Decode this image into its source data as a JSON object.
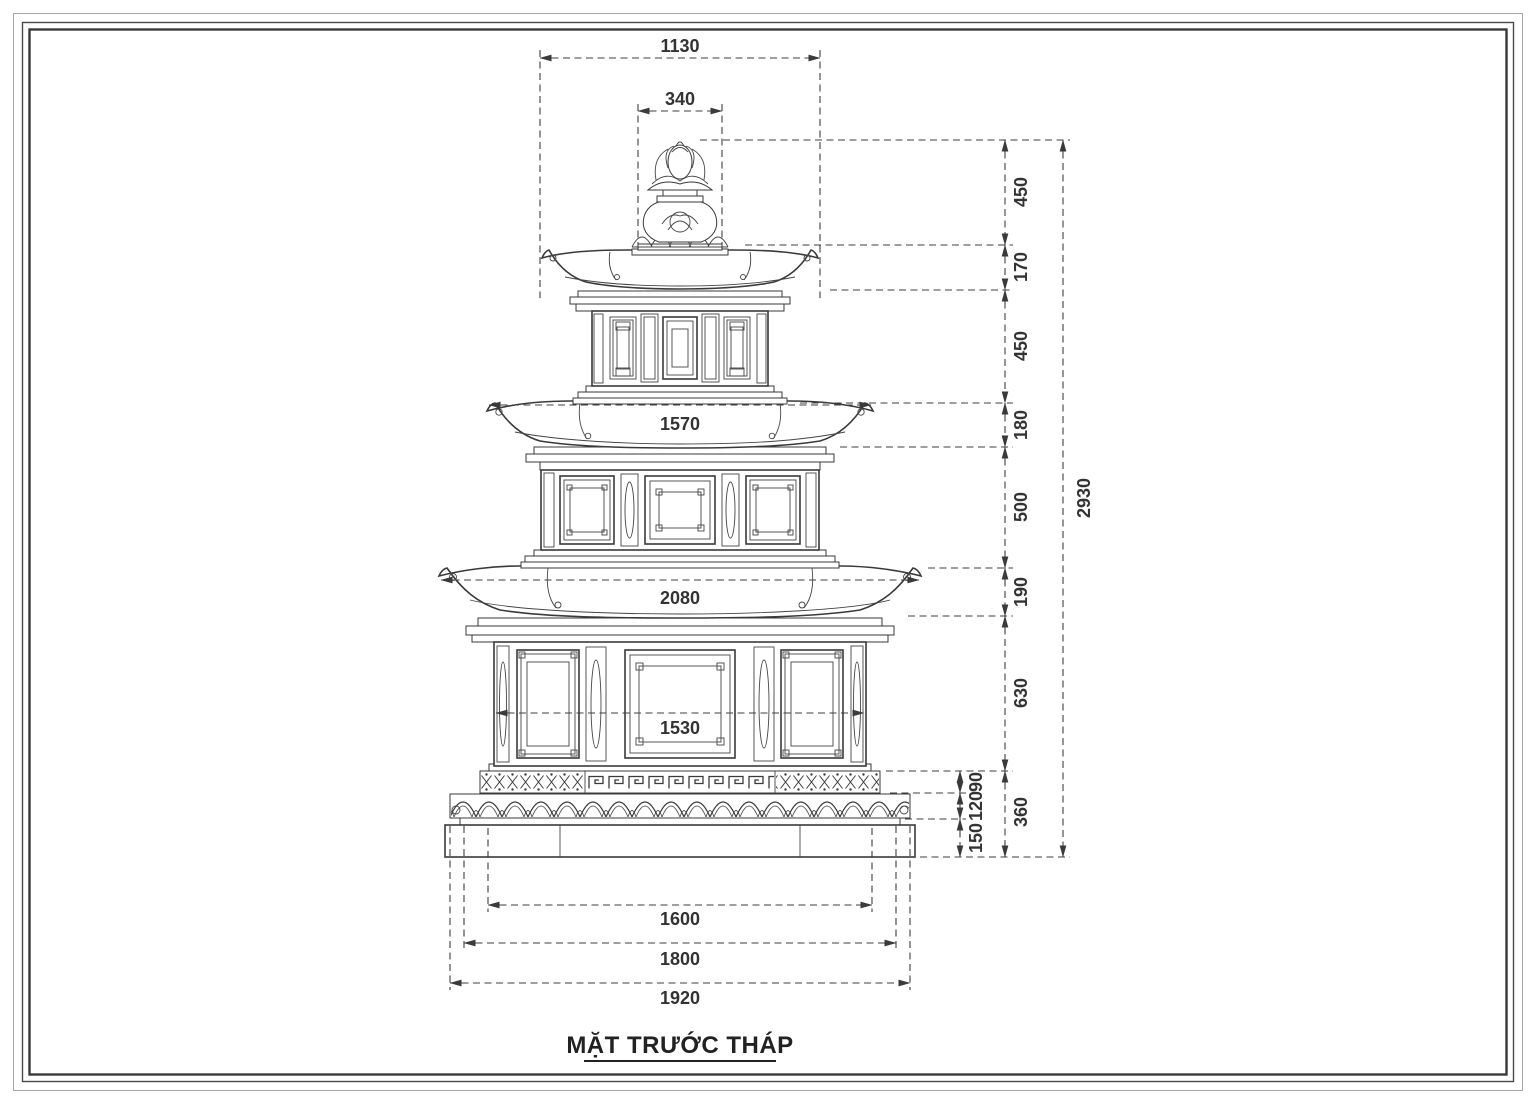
{
  "page": {
    "background": "#ffffff",
    "ink_color": "#3a3a3a",
    "title": "MẶT TRƯỚC THÁP"
  },
  "dimensions": {
    "horizontal": {
      "top_roof_width": "1130",
      "finial_width": "340",
      "middle_roof_width": "1570",
      "lower_roof_width": "2080",
      "lower_body_width": "1530",
      "base_upper_width": "1600",
      "base_middle_width": "1800",
      "base_bottom_width": "1920"
    },
    "vertical": {
      "finial_height": "450",
      "top_roof_height": "170",
      "top_body_height": "450",
      "middle_roof_height": "180",
      "middle_body_height": "500",
      "lower_roof_height": "190",
      "lower_body_height": "630",
      "base_total_height": "360",
      "base_band_height": "90",
      "base_molding_height": "120",
      "base_plinth_height": "150",
      "total_height": "2930"
    }
  }
}
